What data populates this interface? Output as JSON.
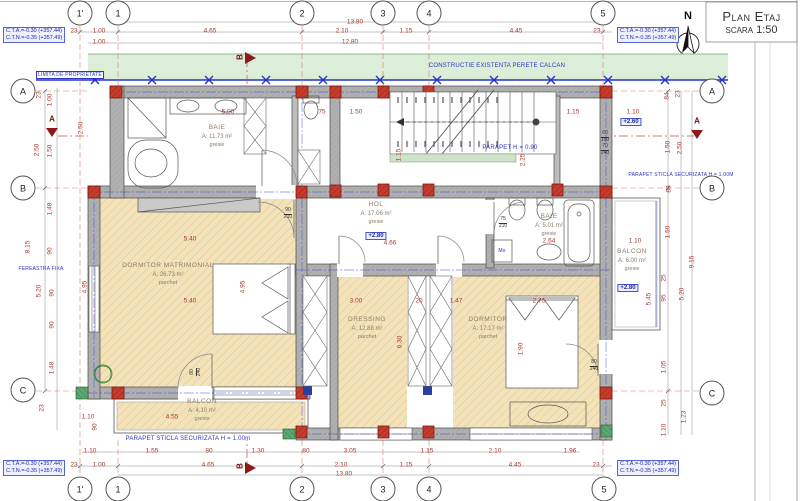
{
  "title": {
    "line1": "Plan Etaj",
    "line2": "scara 1:50"
  },
  "compass": {
    "label": "N"
  },
  "elevation_note": {
    "line1": "C.T.A.=-0.30 (+357.44)",
    "line2": "C.T.N.=-0.35 (+357.49)",
    "positions": [
      {
        "x": 3,
        "y": 27
      },
      {
        "x": 617,
        "y": 27
      },
      {
        "x": 3,
        "y": 460
      },
      {
        "x": 617,
        "y": 460
      }
    ]
  },
  "grid_bubbles": [
    {
      "label": "1'",
      "x": 80,
      "y": 13
    },
    {
      "label": "1",
      "x": 118,
      "y": 13
    },
    {
      "label": "2",
      "x": 302,
      "y": 13
    },
    {
      "label": "3",
      "x": 383,
      "y": 13
    },
    {
      "label": "4",
      "x": 429,
      "y": 13
    },
    {
      "label": "5",
      "x": 603,
      "y": 13
    },
    {
      "label": "1'",
      "x": 80,
      "y": 489
    },
    {
      "label": "1",
      "x": 118,
      "y": 489
    },
    {
      "label": "2",
      "x": 302,
      "y": 489
    },
    {
      "label": "3",
      "x": 383,
      "y": 489
    },
    {
      "label": "4",
      "x": 429,
      "y": 489
    },
    {
      "label": "5",
      "x": 604,
      "y": 489
    },
    {
      "label": "A",
      "x": 23,
      "y": 91
    },
    {
      "label": "B",
      "x": 23,
      "y": 188
    },
    {
      "label": "C",
      "x": 23,
      "y": 390
    },
    {
      "label": "A",
      "x": 712,
      "y": 91
    },
    {
      "label": "B",
      "x": 712,
      "y": 188
    },
    {
      "label": "C",
      "x": 712,
      "y": 393
    }
  ],
  "section_markers": [
    {
      "label": "A",
      "x": 52,
      "y": 119,
      "rot": false
    },
    {
      "label": "A",
      "x": 697,
      "y": 121,
      "rot": false
    },
    {
      "label": "B",
      "x": 240,
      "y": 57,
      "rot": true
    },
    {
      "label": "B",
      "x": 240,
      "y": 466,
      "rot": true
    }
  ],
  "rooms": [
    {
      "name": "BAIE",
      "area": "A: 11.73 m²",
      "floor": "gresie",
      "x": 217,
      "y": 124
    },
    {
      "name": "HOL",
      "area": "A: 17.06 m²",
      "floor": "gresie",
      "x": 376,
      "y": 201
    },
    {
      "name": "BAIE",
      "area": "A: 5.01 m²",
      "floor": "gresie",
      "x": 549,
      "y": 213
    },
    {
      "name": "DORMITOR MATRIMONIAL",
      "area": "A: 26.73 m²",
      "floor": "parchet",
      "x": 168,
      "y": 262
    },
    {
      "name": "DRESSING",
      "area": "A: 12.88 m²",
      "floor": "parchet",
      "x": 367,
      "y": 316
    },
    {
      "name": "DORMITOR",
      "area": "A: 17.17 m²",
      "floor": "parchet",
      "x": 488,
      "y": 316
    },
    {
      "name": "BALCON",
      "area": "A: 4.10 m²",
      "floor": "gresie",
      "x": 202,
      "y": 398
    },
    {
      "name": "BALCON",
      "area": "A: 6.00 m²",
      "floor": "gresie",
      "x": 632,
      "y": 248
    }
  ],
  "level_badges": [
    {
      "text": "+2.80",
      "x": 376,
      "y": 236
    },
    {
      "text": "+2.60",
      "x": 631,
      "y": 122
    },
    {
      "text": "+2.80",
      "x": 628,
      "y": 288
    }
  ],
  "annotations": [
    {
      "text": "CONSTRUCTIE EXISTENTA PERETE CALCAN",
      "x": 497,
      "y": 66,
      "cls": "blue",
      "name": "constructie-existenta-label"
    },
    {
      "text": "LIMITA DE PROPRIETATE",
      "x": 70,
      "y": 75,
      "cls": "blue tiny boxed",
      "name": "limita-proprietate-label"
    },
    {
      "text": "PARAPET H = 0.90",
      "x": 510,
      "y": 148,
      "cls": "blue",
      "name": "parapet-stairs-label"
    },
    {
      "text": "PARAPET STICLA SECURIZATA H = 1.00M",
      "x": 681,
      "y": 175,
      "cls": "blue tiny",
      "name": "parapet-sticla-right-label"
    },
    {
      "text": "PARAPET STICLA SECURIZATA H = 1.00m",
      "x": 188,
      "y": 439,
      "cls": "blue",
      "name": "parapet-sticla-bottom-label"
    },
    {
      "text": "FEREASTRA FIXA",
      "x": 41,
      "y": 269,
      "cls": "blue tiny",
      "name": "fereastra-fixa-label"
    },
    {
      "text": "Mo",
      "x": 502,
      "y": 251,
      "cls": "blue tiny",
      "name": "washing-machine-label"
    },
    {
      "text": "N",
      "x": 688,
      "y": 16,
      "cls": "north",
      "name": "north-label"
    }
  ],
  "door_sizes": [
    {
      "w": "90",
      "h": "210",
      "x": 288,
      "y": 214,
      "rot": false
    },
    {
      "w": "75",
      "h": "210",
      "x": 503,
      "y": 223,
      "rot": false
    },
    {
      "w": "80",
      "h": "240",
      "x": 594,
      "y": 366,
      "rot": false
    },
    {
      "w": "80",
      "h": "240",
      "x": 196,
      "y": 372,
      "rot": true
    },
    {
      "w": "60",
      "h": "190",
      "x": 605,
      "y": 137,
      "rot": false
    },
    {
      "w": "70",
      "h": "240",
      "x": 605,
      "y": 150,
      "rot": false
    }
  ],
  "dims_h": [
    {
      "t": "13.80",
      "x": 355,
      "y": 22
    },
    {
      "t": "23",
      "x": 74,
      "y": 31
    },
    {
      "t": "1.00",
      "x": 99,
      "y": 31
    },
    {
      "t": "4.65",
      "x": 210,
      "y": 31
    },
    {
      "t": "2.10",
      "x": 342,
      "y": 31
    },
    {
      "t": "1.15",
      "x": 406,
      "y": 31
    },
    {
      "t": "4.45",
      "x": 516,
      "y": 31
    },
    {
      "t": "23",
      "x": 597,
      "y": 31
    },
    {
      "t": "1.00",
      "x": 99,
      "y": 42
    },
    {
      "t": "12.80",
      "x": 350,
      "y": 42
    },
    {
      "t": "5.00",
      "x": 228,
      "y": 112
    },
    {
      "t": "75",
      "x": 322,
      "y": 112
    },
    {
      "t": "1.50",
      "x": 356,
      "y": 112
    },
    {
      "t": "1.15",
      "x": 573,
      "y": 112
    },
    {
      "t": "1.10",
      "x": 633,
      "y": 112
    },
    {
      "t": "4.66",
      "x": 390,
      "y": 243
    },
    {
      "t": "2.64",
      "x": 549,
      "y": 241
    },
    {
      "t": "1.10",
      "x": 635,
      "y": 241
    },
    {
      "t": "5.40",
      "x": 190,
      "y": 239
    },
    {
      "t": "5.40",
      "x": 190,
      "y": 301
    },
    {
      "t": "3.00",
      "x": 356,
      "y": 301
    },
    {
      "t": "20",
      "x": 419,
      "y": 301
    },
    {
      "t": "1.47",
      "x": 456,
      "y": 301
    },
    {
      "t": "2.75",
      "x": 539,
      "y": 301
    },
    {
      "t": "4.55",
      "x": 172,
      "y": 417
    },
    {
      "t": "1.10",
      "x": 88,
      "y": 417
    },
    {
      "t": "1.10",
      "x": 90,
      "y": 451
    },
    {
      "t": "1.55",
      "x": 152,
      "y": 451
    },
    {
      "t": "80",
      "x": 209,
      "y": 451
    },
    {
      "t": "1.30",
      "x": 258,
      "y": 451
    },
    {
      "t": "80",
      "x": 306,
      "y": 451
    },
    {
      "t": "3.05",
      "x": 350,
      "y": 451
    },
    {
      "t": "1.15",
      "x": 427,
      "y": 451
    },
    {
      "t": "2.10",
      "x": 495,
      "y": 451
    },
    {
      "t": "1.96",
      "x": 570,
      "y": 451
    },
    {
      "t": "23",
      "x": 74,
      "y": 465
    },
    {
      "t": "1.00",
      "x": 99,
      "y": 465
    },
    {
      "t": "4.65",
      "x": 208,
      "y": 465
    },
    {
      "t": "2.10",
      "x": 341,
      "y": 465
    },
    {
      "t": "1.15",
      "x": 406,
      "y": 465
    },
    {
      "t": "4.45",
      "x": 515,
      "y": 465
    },
    {
      "t": "23",
      "x": 596,
      "y": 465
    },
    {
      "t": "13.80",
      "x": 344,
      "y": 474
    }
  ],
  "dims_v": [
    {
      "t": "23",
      "x": 39,
      "y": 95
    },
    {
      "t": "1.00",
      "x": 50,
      "y": 100
    },
    {
      "t": "2.50",
      "x": 37,
      "y": 150
    },
    {
      "t": "1.50",
      "x": 50,
      "y": 151
    },
    {
      "t": "1.48",
      "x": 50,
      "y": 209
    },
    {
      "t": "8.15",
      "x": 28,
      "y": 247
    },
    {
      "t": "90",
      "x": 50,
      "y": 251
    },
    {
      "t": "5.20",
      "x": 39,
      "y": 291
    },
    {
      "t": "90",
      "x": 52,
      "y": 293
    },
    {
      "t": "90",
      "x": 52,
      "y": 325
    },
    {
      "t": "1.48",
      "x": 52,
      "y": 368
    },
    {
      "t": "23",
      "x": 42,
      "y": 408
    },
    {
      "t": "2.50",
      "x": 81,
      "y": 128
    },
    {
      "t": "1.15",
      "x": 399,
      "y": 155
    },
    {
      "t": "2.25",
      "x": 523,
      "y": 160
    },
    {
      "t": "4.95",
      "x": 85,
      "y": 287
    },
    {
      "t": "4.95",
      "x": 243,
      "y": 287
    },
    {
      "t": "6.30",
      "x": 400,
      "y": 342
    },
    {
      "t": "1.90",
      "x": 521,
      "y": 349
    },
    {
      "t": "90",
      "x": 95,
      "y": 427
    },
    {
      "t": "84",
      "x": 667,
      "y": 96
    },
    {
      "t": "23",
      "x": 678,
      "y": 94
    },
    {
      "t": "1.50",
      "x": 668,
      "y": 147
    },
    {
      "t": "2.50",
      "x": 680,
      "y": 148
    },
    {
      "t": "88",
      "x": 669,
      "y": 189
    },
    {
      "t": "1.50",
      "x": 668,
      "y": 232
    },
    {
      "t": "25",
      "x": 664,
      "y": 278
    },
    {
      "t": "95",
      "x": 664,
      "y": 298
    },
    {
      "t": "5.20",
      "x": 682,
      "y": 294
    },
    {
      "t": "9.15",
      "x": 692,
      "y": 262
    },
    {
      "t": "5.45",
      "x": 649,
      "y": 299
    },
    {
      "t": "1.05",
      "x": 664,
      "y": 367
    },
    {
      "t": "25",
      "x": 664,
      "y": 403
    },
    {
      "t": "1.23",
      "x": 684,
      "y": 417
    },
    {
      "t": "1.10",
      "x": 664,
      "y": 430
    }
  ]
}
